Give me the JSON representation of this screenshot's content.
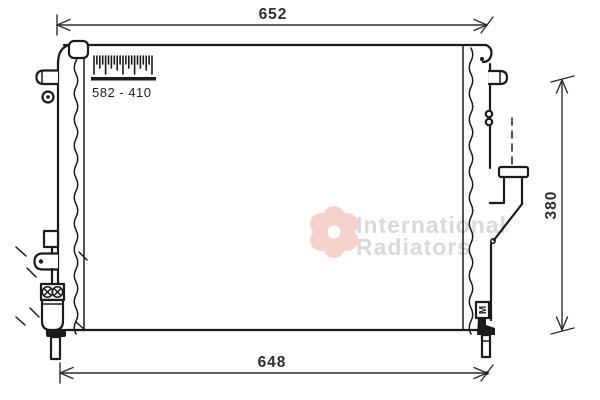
{
  "dimensions": {
    "top_width": "652",
    "bottom_width": "648",
    "side_height": "380",
    "core_size": "582 - 410"
  },
  "markings": {
    "bracket_label": "M"
  },
  "watermark": {
    "line1": "International",
    "line2": "Radiators"
  },
  "colors": {
    "ink": "#1b1b1b",
    "dim": "#2e2e2e",
    "watermark_text": "#d9d9d9",
    "watermark_logo": "#f4d2cb",
    "background": "#ffffff"
  }
}
